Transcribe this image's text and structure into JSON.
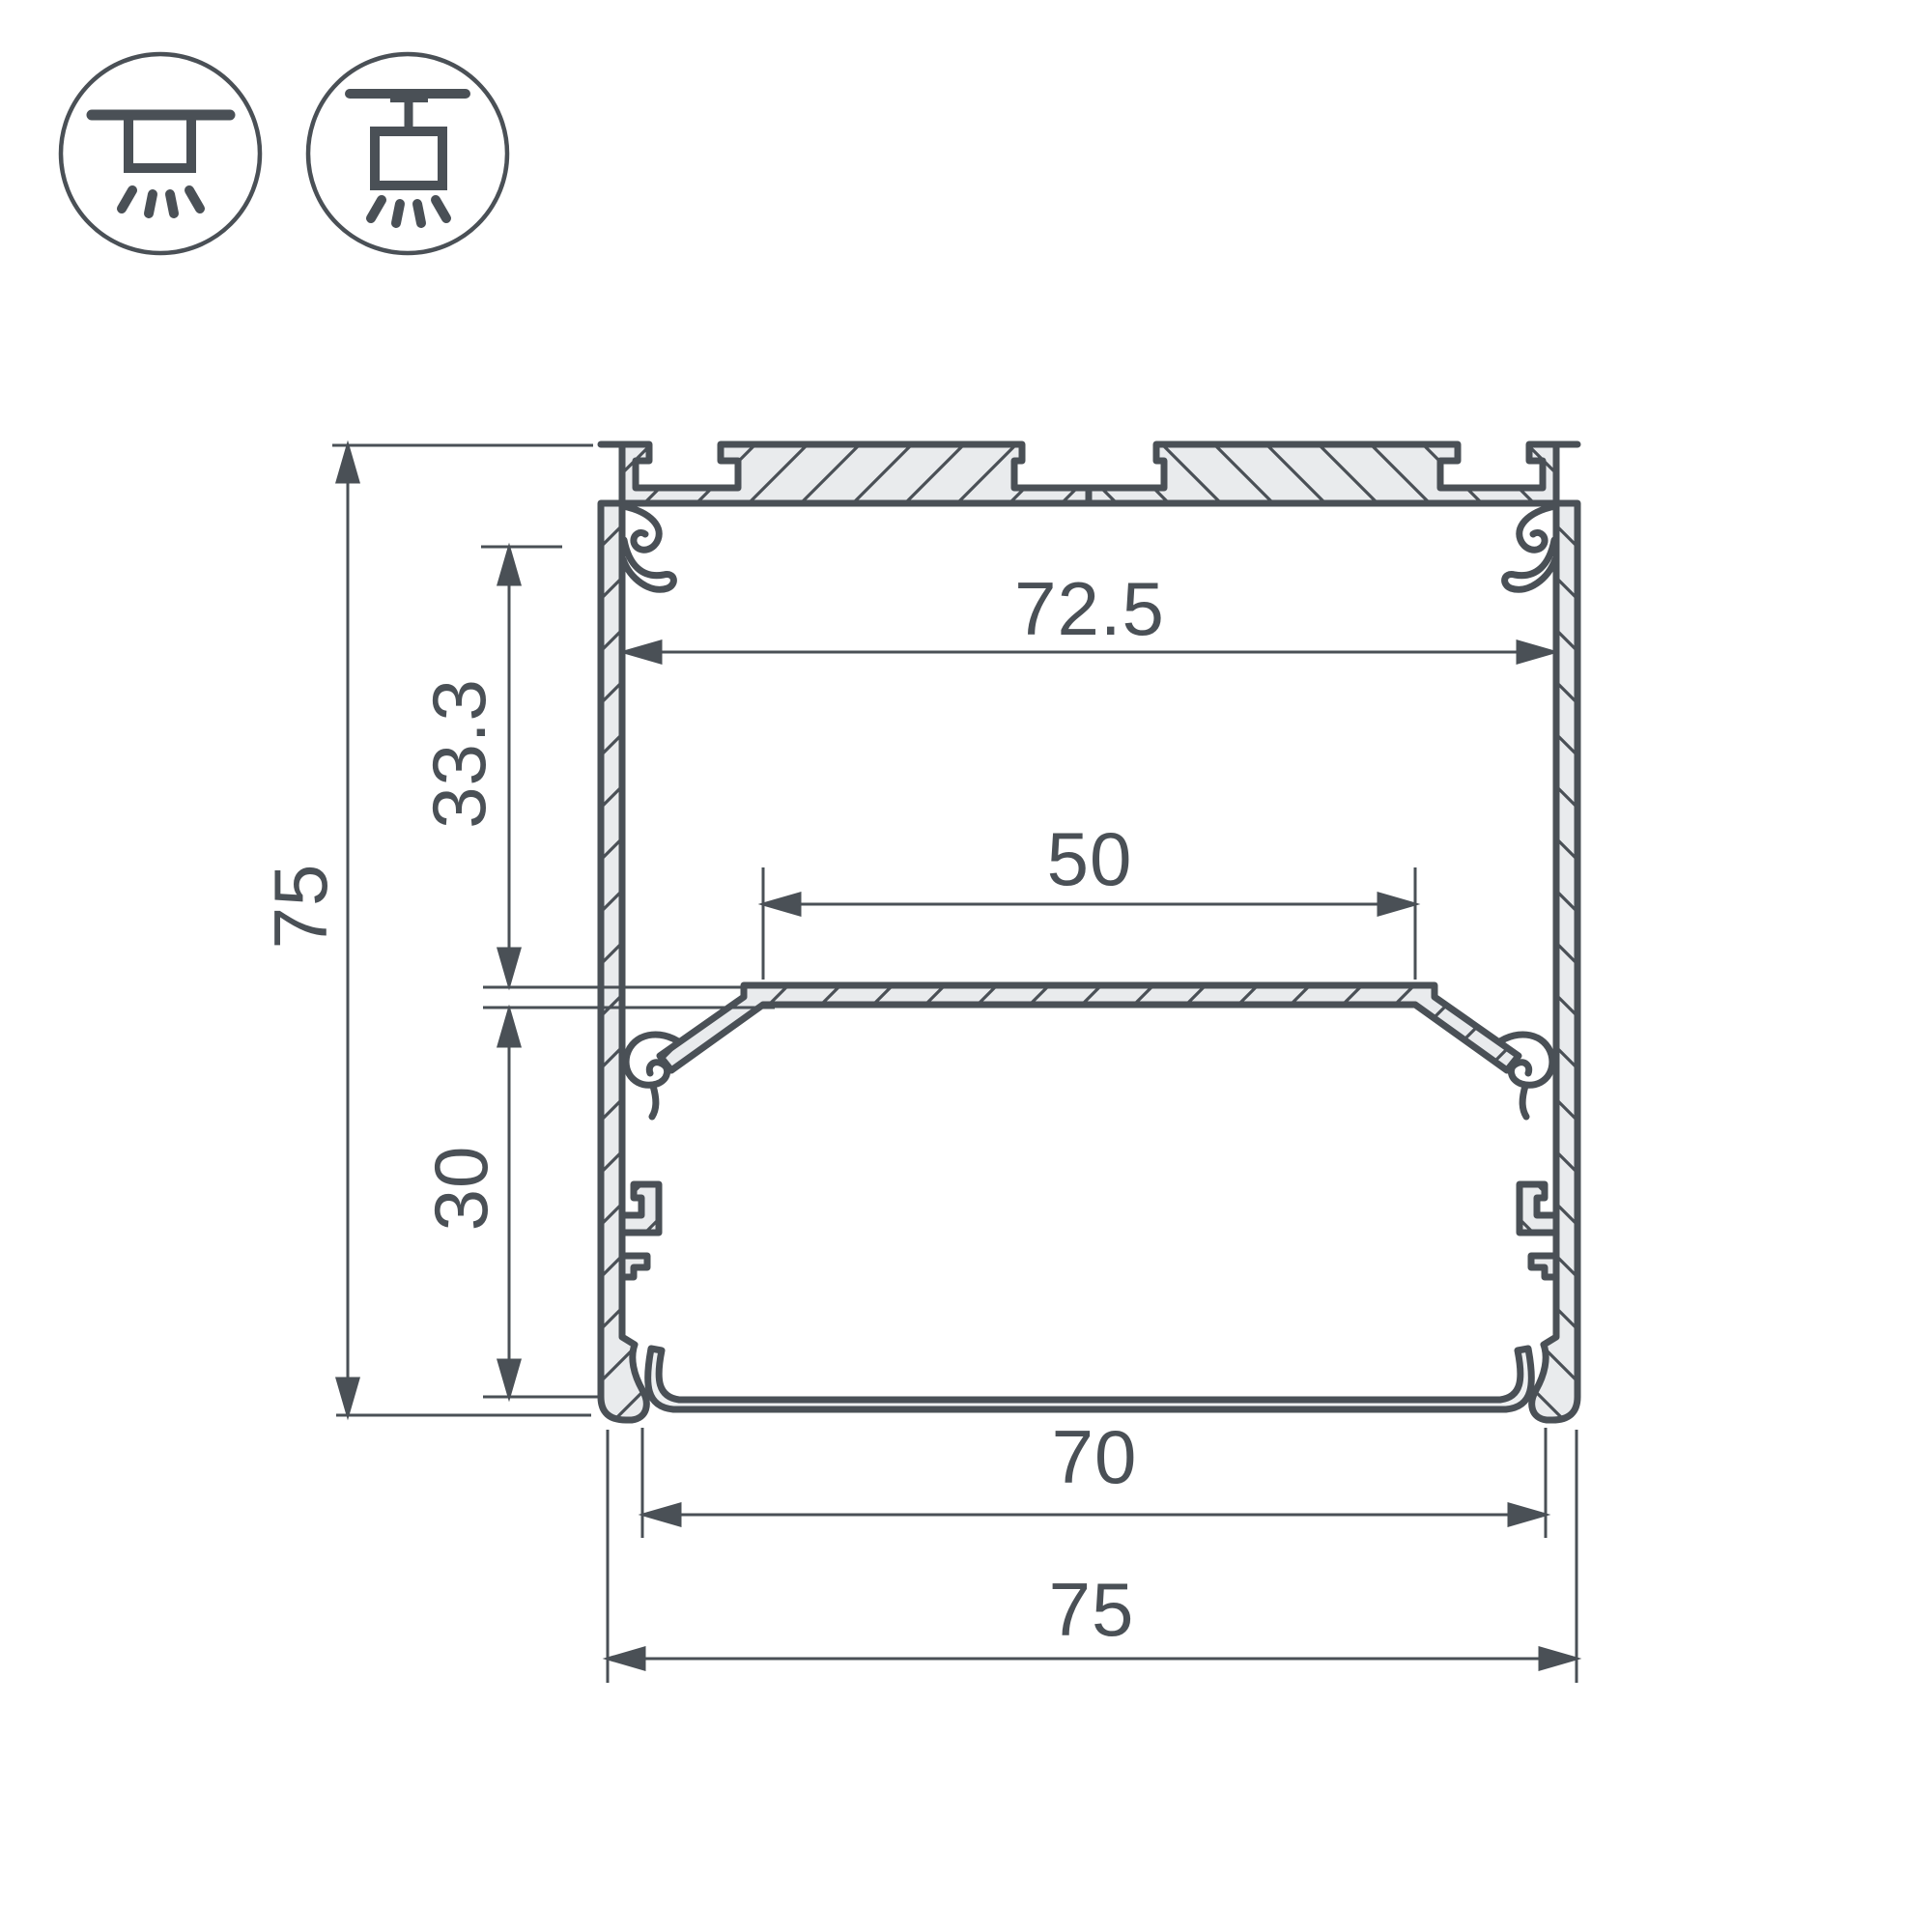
{
  "drawing": {
    "type": "profile-cross-section",
    "description": "Dimensioned cross-section drawing of an aluminium LED profile"
  },
  "icons": [
    {
      "name": "surface-mount-light-icon"
    },
    {
      "name": "pendant-light-icon"
    }
  ],
  "dimensions": {
    "overall_height": {
      "label": "75"
    },
    "upper_inner_height": {
      "label": "33.3"
    },
    "lower_inner_height": {
      "label": "30"
    },
    "inner_width_top": {
      "label": "72.5"
    },
    "led_platform_width": {
      "label": "50"
    },
    "bottom_opening_width": {
      "label": "70"
    },
    "overall_width": {
      "label": "75"
    }
  },
  "colors": {
    "line": "#4a5056",
    "body_fill": "#e9ebed",
    "background": "#ffffff"
  }
}
